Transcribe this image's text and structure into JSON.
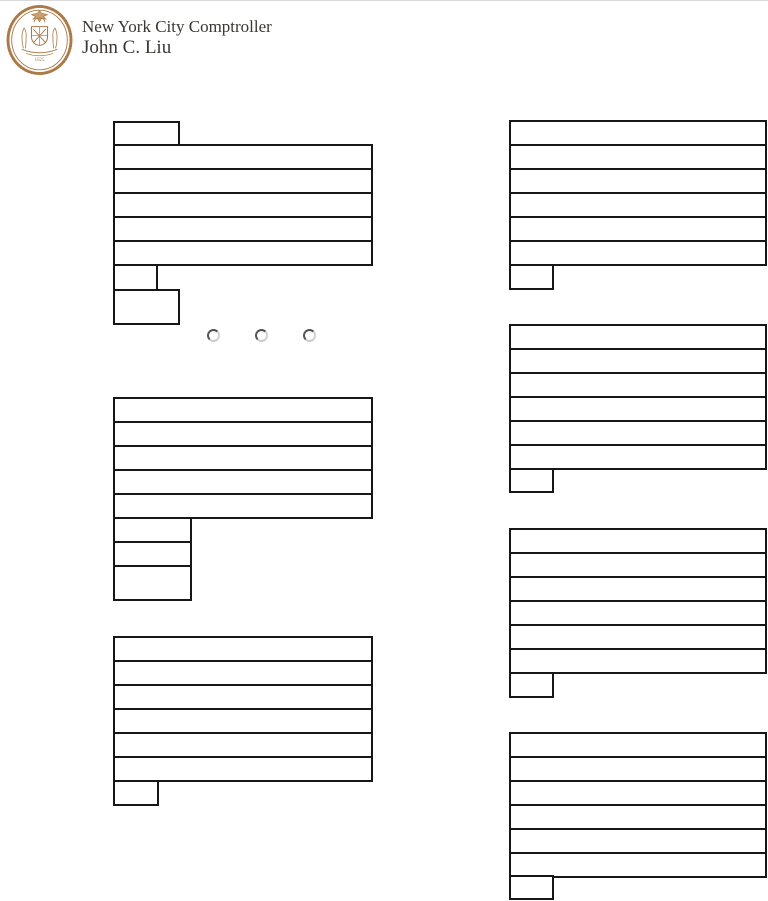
{
  "meta": {
    "page_bg": "#ffffff",
    "box_border_color": "#171717",
    "seal_color": "#ab7a49",
    "header_text_color": "#3a3632"
  },
  "header": {
    "org_line": "New York City Comptroller",
    "name_line": "John C. Liu",
    "seal": {
      "name": "nyc-comptroller-seal",
      "year": "1625"
    }
  },
  "form": {
    "radio_group": {
      "options": [
        {
          "name": "radio-option-1",
          "checked": false
        },
        {
          "name": "radio-option-2",
          "checked": false
        },
        {
          "name": "radio-option-3",
          "checked": false
        }
      ]
    },
    "blocks": [
      {
        "id": "left-block-1",
        "fields": [
          {
            "name": "field-1",
            "value": ""
          },
          {
            "name": "field-2",
            "value": ""
          },
          {
            "name": "field-3",
            "value": ""
          },
          {
            "name": "field-4",
            "value": ""
          },
          {
            "name": "field-5",
            "value": ""
          },
          {
            "name": "field-6",
            "value": ""
          },
          {
            "name": "field-7",
            "value": ""
          },
          {
            "name": "field-8",
            "value": ""
          }
        ]
      },
      {
        "id": "left-block-2",
        "fields": [
          {
            "name": "field-1",
            "value": ""
          },
          {
            "name": "field-2",
            "value": ""
          },
          {
            "name": "field-3",
            "value": ""
          },
          {
            "name": "field-4",
            "value": ""
          },
          {
            "name": "field-5",
            "value": ""
          },
          {
            "name": "field-6",
            "value": ""
          },
          {
            "name": "field-7",
            "value": ""
          },
          {
            "name": "field-8",
            "value": ""
          }
        ]
      },
      {
        "id": "left-block-3",
        "fields": [
          {
            "name": "field-1",
            "value": ""
          },
          {
            "name": "field-2",
            "value": ""
          },
          {
            "name": "field-3",
            "value": ""
          },
          {
            "name": "field-4",
            "value": ""
          },
          {
            "name": "field-5",
            "value": ""
          },
          {
            "name": "field-6",
            "value": ""
          },
          {
            "name": "field-7",
            "value": ""
          }
        ]
      },
      {
        "id": "right-block-1",
        "fields": [
          {
            "name": "field-1",
            "value": ""
          },
          {
            "name": "field-2",
            "value": ""
          },
          {
            "name": "field-3",
            "value": ""
          },
          {
            "name": "field-4",
            "value": ""
          },
          {
            "name": "field-5",
            "value": ""
          },
          {
            "name": "field-6",
            "value": ""
          },
          {
            "name": "field-7",
            "value": ""
          }
        ]
      },
      {
        "id": "right-block-2",
        "fields": [
          {
            "name": "field-1",
            "value": ""
          },
          {
            "name": "field-2",
            "value": ""
          },
          {
            "name": "field-3",
            "value": ""
          },
          {
            "name": "field-4",
            "value": ""
          },
          {
            "name": "field-5",
            "value": ""
          },
          {
            "name": "field-6",
            "value": ""
          },
          {
            "name": "field-7",
            "value": ""
          }
        ]
      },
      {
        "id": "right-block-3",
        "fields": [
          {
            "name": "field-1",
            "value": ""
          },
          {
            "name": "field-2",
            "value": ""
          },
          {
            "name": "field-3",
            "value": ""
          },
          {
            "name": "field-4",
            "value": ""
          },
          {
            "name": "field-5",
            "value": ""
          },
          {
            "name": "field-6",
            "value": ""
          },
          {
            "name": "field-7",
            "value": ""
          }
        ]
      },
      {
        "id": "right-block-4",
        "fields": [
          {
            "name": "field-1",
            "value": ""
          },
          {
            "name": "field-2",
            "value": ""
          },
          {
            "name": "field-3",
            "value": ""
          },
          {
            "name": "field-4",
            "value": ""
          },
          {
            "name": "field-5",
            "value": ""
          },
          {
            "name": "field-6",
            "value": ""
          },
          {
            "name": "field-7",
            "value": ""
          }
        ]
      }
    ]
  }
}
